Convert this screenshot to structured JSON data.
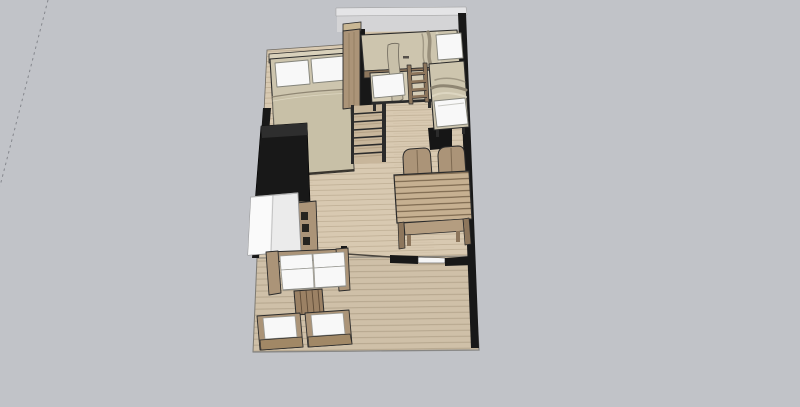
{
  "app": {
    "name": "3d-floorplan-viewport",
    "view": "top-down-perspective"
  },
  "viewport": {
    "axis_guide": "dashed-construction-line",
    "background": "#c1c3c8"
  },
  "scene": {
    "colors": {
      "background": "#c1c3c8",
      "floor": "#d8c9b1",
      "floor_plank_line": "#bcac92",
      "deck": "#cfc0a8",
      "deck_plank_line": "#b2a38a",
      "wall_dark": "#181818",
      "wall_light": "#e4e4e6",
      "wall_light_inner": "#d4d4d6",
      "outline": "#2b2b2b",
      "wood_dark": "#8d765c",
      "wood_mid": "#ab9478",
      "wood_light": "#c9b794",
      "blanket": "#cdc5ae",
      "blanket_shade": "#c4bba3",
      "white_soft": "#f8f8f8",
      "fridge": "#ebebeb",
      "axis": "#85878d",
      "tread": "#c8b69b"
    },
    "areas": [
      {
        "id": "interior-floor",
        "label": "Interior wood floor"
      },
      {
        "id": "deck",
        "label": "Deck terrace"
      }
    ],
    "furniture": [
      {
        "id": "double-bed",
        "label": "Double bed with two pillows"
      },
      {
        "id": "wardrobe",
        "label": "Tall wardrobe column"
      },
      {
        "id": "loft-bed",
        "label": "Loft bed platform"
      },
      {
        "id": "bunk-bed-lower",
        "label": "Lower bunk bed"
      },
      {
        "id": "bunk-ladder",
        "label": "Bunk bed ladder"
      },
      {
        "id": "single-bed",
        "label": "Single bed along right wall"
      },
      {
        "id": "staircase",
        "label": "Staircase"
      },
      {
        "id": "kitchen-counter",
        "label": "Black kitchen counter"
      },
      {
        "id": "kitchen-cabinet",
        "label": "Kitchen cabinet with drawers"
      },
      {
        "id": "refrigerator",
        "label": "Refrigerator"
      },
      {
        "id": "dining-table",
        "label": "Plank dining table"
      },
      {
        "id": "dining-chair-left",
        "label": "Dining chair left"
      },
      {
        "id": "dining-chair-right",
        "label": "Dining chair right"
      },
      {
        "id": "dining-bench",
        "label": "Dining bench"
      },
      {
        "id": "sofa",
        "label": "Two-seat sofa"
      },
      {
        "id": "coffee-table",
        "label": "Coffee table"
      },
      {
        "id": "armchair-left",
        "label": "Armchair left"
      },
      {
        "id": "armchair-right",
        "label": "Armchair right"
      }
    ],
    "walls": [
      {
        "id": "top-wall",
        "label": "Light upper wall"
      },
      {
        "id": "left-wall",
        "label": "Dark left wall"
      },
      {
        "id": "right-wall",
        "label": "Dark right wall"
      },
      {
        "id": "front-wall",
        "label": "Front wall with window and door opening"
      }
    ]
  }
}
